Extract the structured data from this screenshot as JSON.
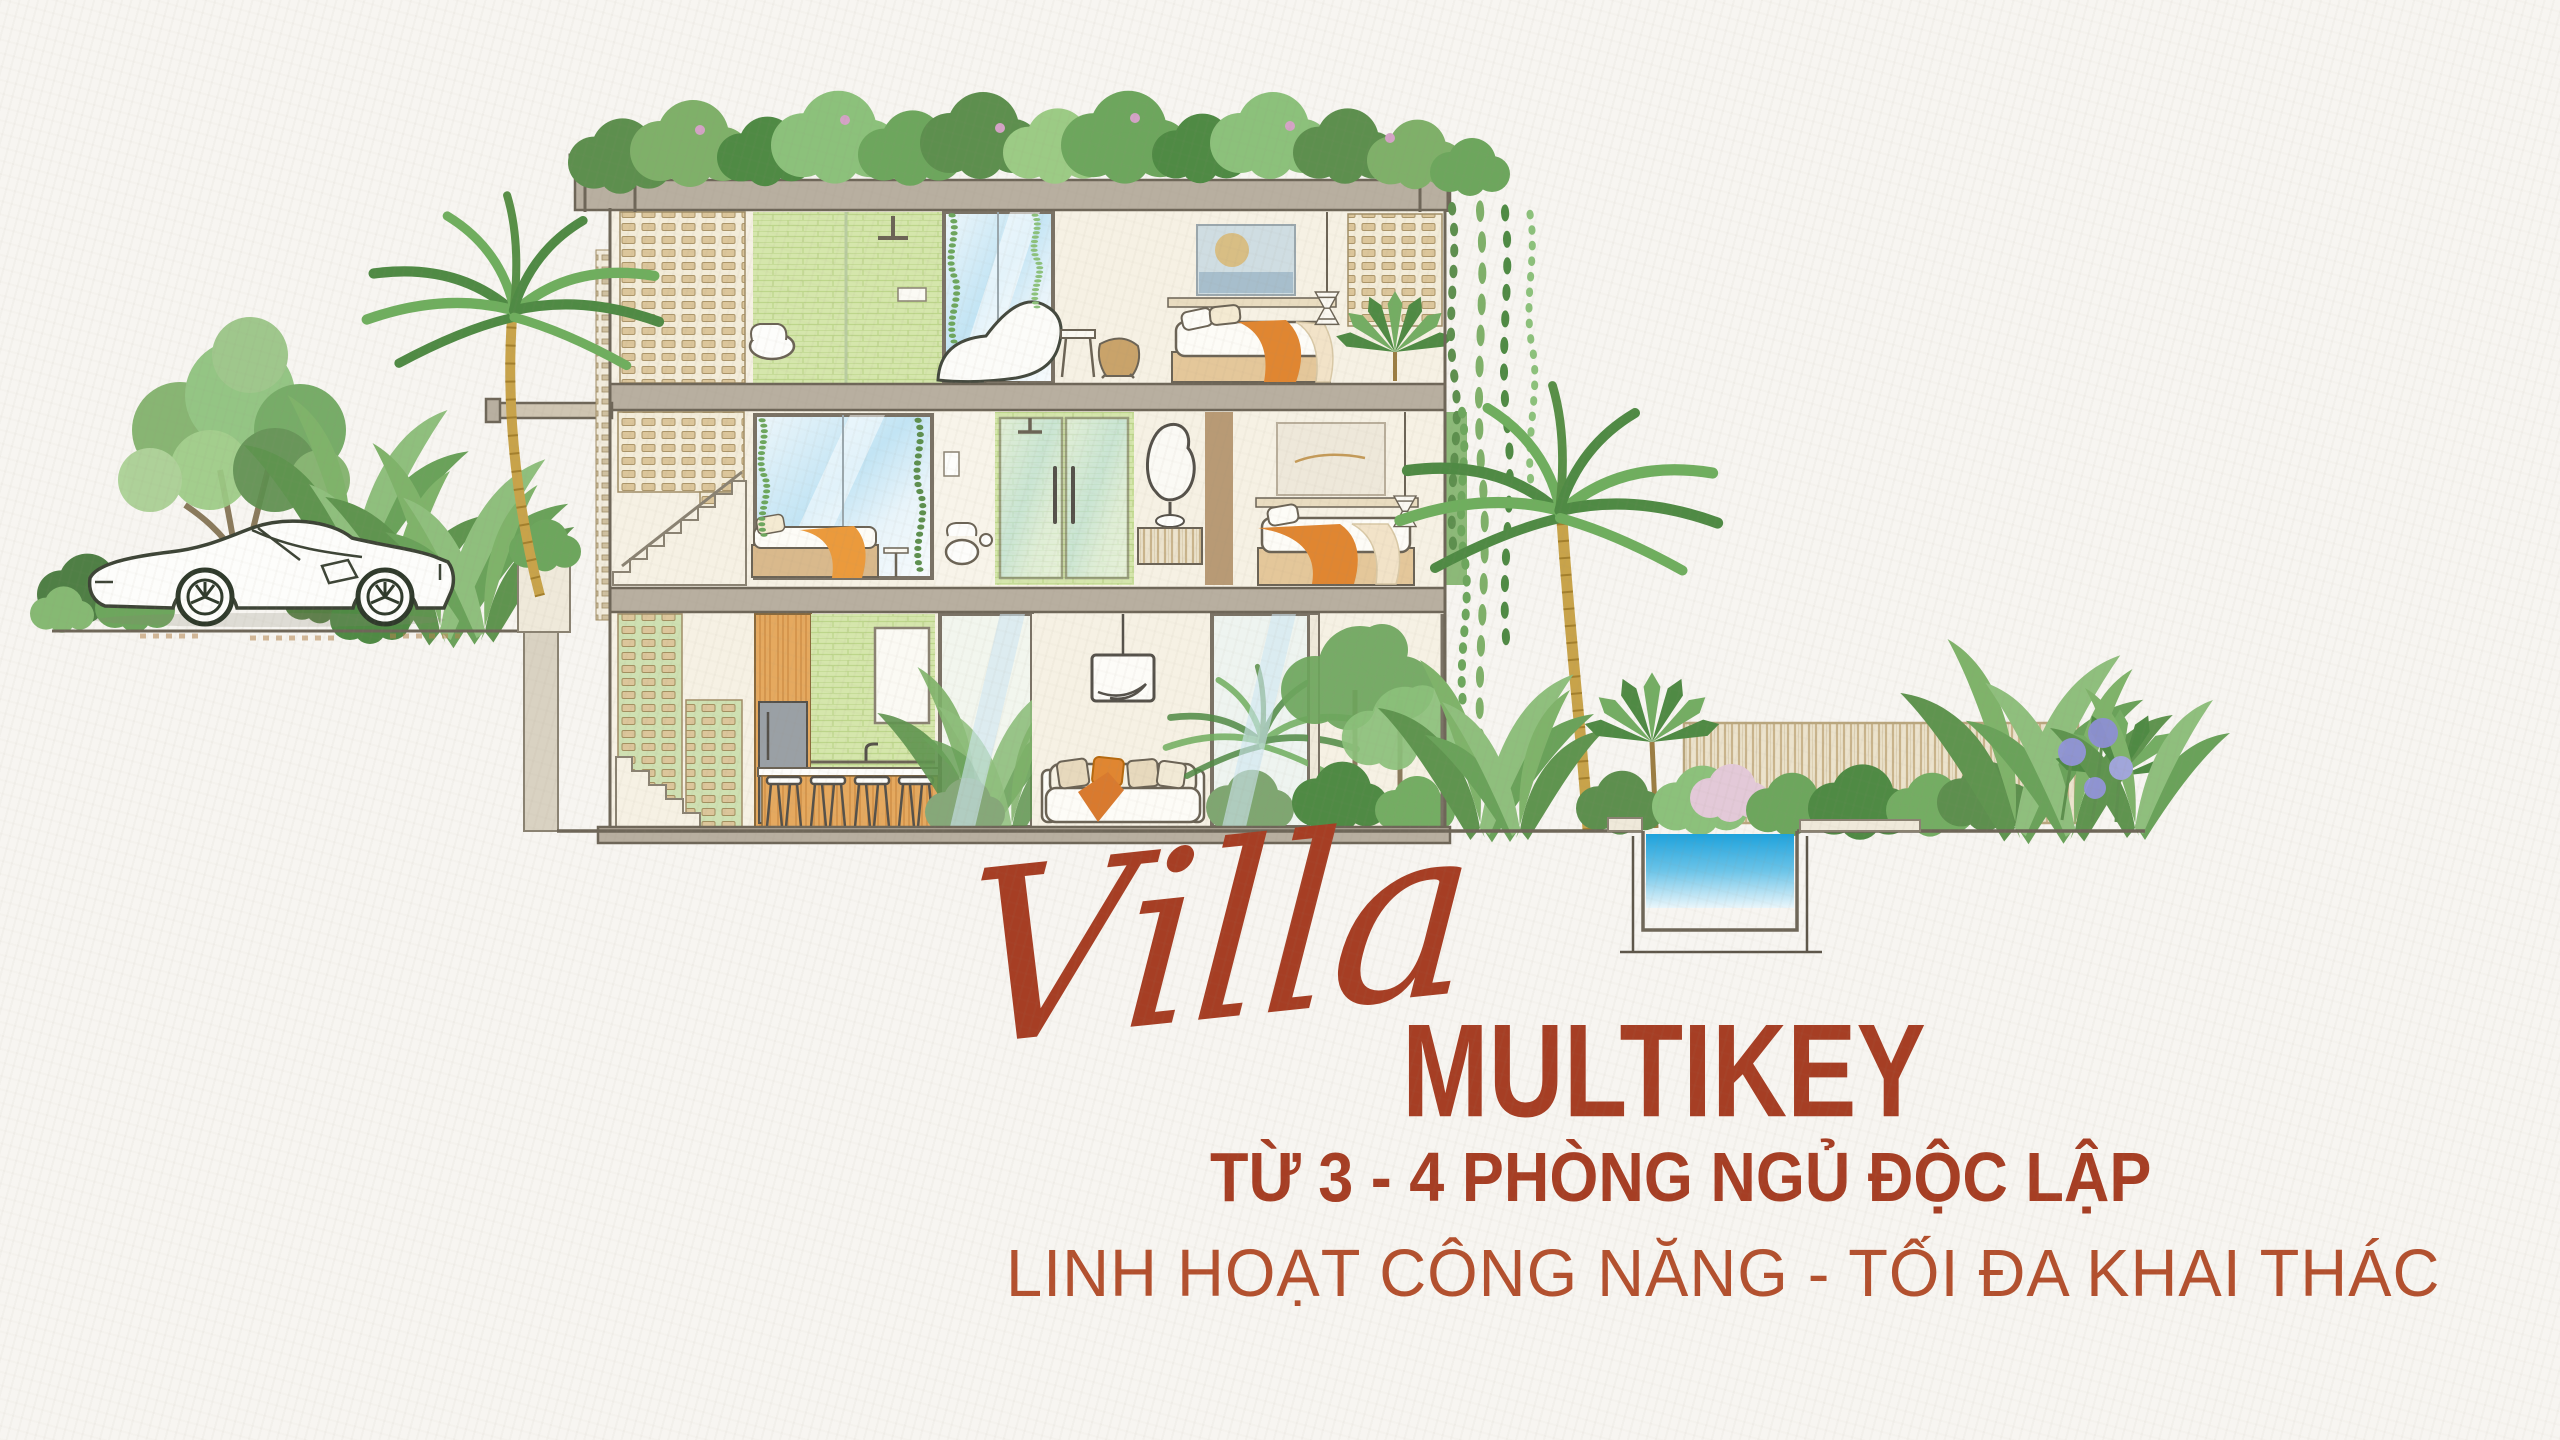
{
  "poster": {
    "background_color": "#f7f5f1",
    "script_word": "Villa",
    "title": "MULTIKEY",
    "subtitle": "TỪ 3 - 4 PHÒNG NGỦ ĐỘC LẬP",
    "tagline": "LINH HOẠT CÔNG NĂNG - TỐI ĐA KHAI THÁC",
    "text_color": "#a63e24",
    "tagline_color": "#b3502e"
  },
  "illustration": {
    "type": "architectural-cross-section",
    "subject": "three-storey tropical villa section with garden, pool and sports car",
    "elements": [
      "roof-garden",
      "survey-posts",
      "breeze-block-walls",
      "top-floor-bathroom",
      "bathtub",
      "top-floor-bedroom",
      "wall-art",
      "middle-floor-daybed",
      "middle-floor-shower",
      "vanity-mirror",
      "middle-floor-bedroom",
      "staircase",
      "kitchen",
      "bar-stools",
      "pendant-lamp",
      "sofa",
      "white-sports-car",
      "palm-trees",
      "banana-plants",
      "hanging-vines",
      "slatted-fence",
      "plunge-pool",
      "agapanthus-flowers"
    ],
    "palette": {
      "foliage_green": "#6da65d",
      "foliage_light": "#9ccb85",
      "foliage_dark": "#4f8a44",
      "concrete": "#b8afa0",
      "outline": "#6e6658",
      "cream_wall": "#f6f1e4",
      "breeze_block": "#dcc69b",
      "green_tile": "#d5e6ac",
      "wood": "#e5a95f",
      "accent_orange": "#e08631",
      "pool_blue": "#1ea2dc",
      "glass_blue": "#c2e4f4",
      "palm_trunk": "#c8a34a"
    }
  }
}
